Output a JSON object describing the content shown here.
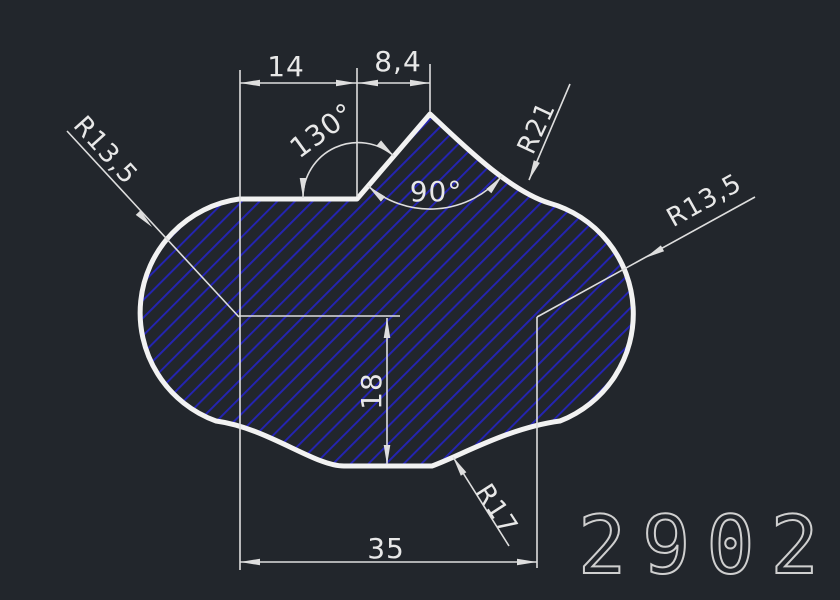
{
  "drawing": {
    "part_number": "2902",
    "labels": {
      "dim_14": "14",
      "dim_8_4": "8,4",
      "angle_130": "130°",
      "angle_90": "90°",
      "r21": "R21",
      "r13_5_left": "R13,5",
      "r13_5_right": "R13,5",
      "dim_18": "18",
      "r17": "R17",
      "dim_35": "35"
    },
    "colors": {
      "background": "#22262c",
      "outline": "#f2f2f2",
      "hatch": "#2424b4",
      "dim_lines": "#dedede",
      "labels": "#e8e8e8",
      "part_number": "#cfcfcf"
    }
  }
}
